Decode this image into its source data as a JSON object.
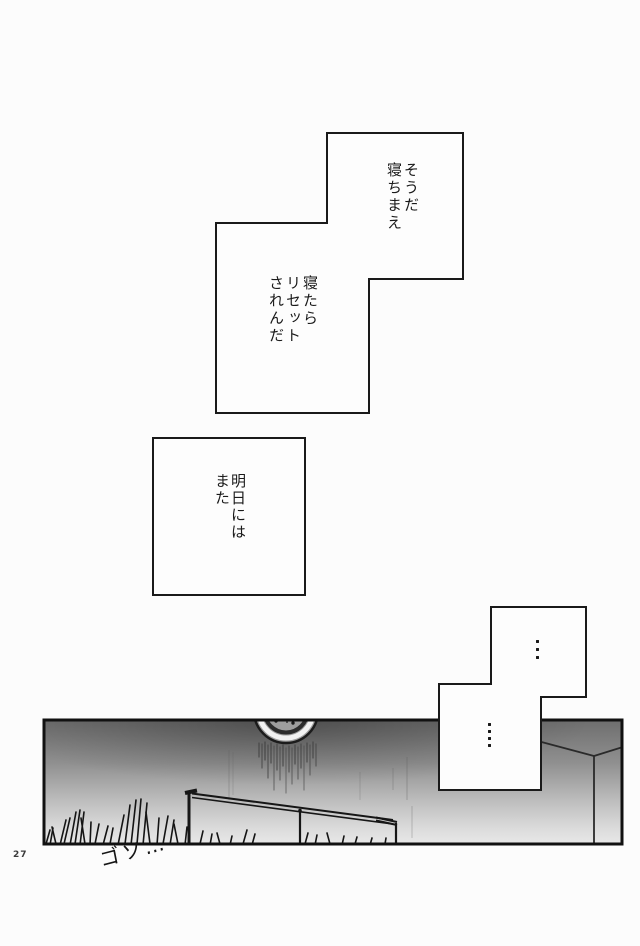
{
  "meta": {
    "kind": "manga-page",
    "page_number": "27"
  },
  "colors": {
    "ink": "#1a1a1a",
    "paper": "#fcfcfc",
    "panel_gradient_top": "#6e6e6e",
    "panel_gradient_bottom": "#e8e8e8"
  },
  "dialogue": {
    "bubble_top": "そうだ\n寝ちまえ",
    "bubble_mid": "寝たら\nリセット\nされんだ",
    "bubble_square": "明日には\nまた",
    "silent_upper_text": "…",
    "silent_upper_dots": 3,
    "silent_lower_text": "….",
    "silent_lower_dots": 4
  },
  "sfx": {
    "rustle": "ゴソ…"
  },
  "footer": {
    "page_number": "27"
  }
}
